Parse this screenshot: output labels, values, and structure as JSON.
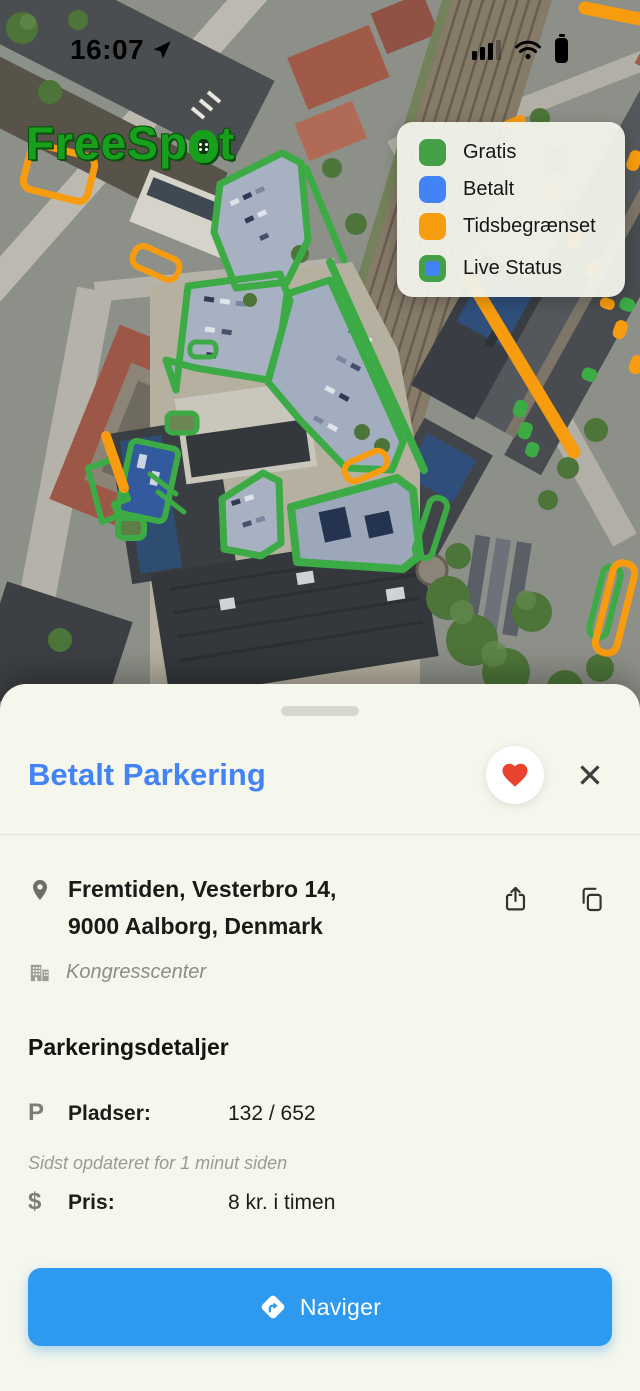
{
  "status_bar": {
    "time": "16:07"
  },
  "map": {
    "logo_full": "FreeSpot",
    "logo_prefix": "FreeSp",
    "logo_suffix": "t",
    "legend": {
      "items": [
        {
          "label": "Gratis",
          "color": "#43a047"
        },
        {
          "label": "Betalt",
          "color": "#4284f5"
        },
        {
          "label": "Tidsbegrænset",
          "color": "#f79c0e"
        },
        {
          "label": "Live Status",
          "outer_color": "#43a047",
          "inner_color": "#4284f5"
        }
      ]
    }
  },
  "sheet": {
    "title": "Betalt Parkering",
    "close_glyph": "✕",
    "address": {
      "line1": "Fremtiden, Vesterbro 14,",
      "line2": "9000 Aalborg, Denmark",
      "venue": "Kongresscenter"
    },
    "details": {
      "heading": "Parkeringsdetaljer",
      "spots_icon": "P",
      "spots_label": "Pladser:",
      "spots_value": "132 / 652",
      "updated_note": "Sidst opdateret for 1 minut siden",
      "price_icon": "$",
      "price_label": "Pris:",
      "price_value": "8 kr. i timen"
    },
    "navigate": {
      "label": "Naviger"
    }
  },
  "colors": {
    "accent_blue": "#4483f5",
    "button_blue": "#2d9af0",
    "free_green": "#43a047",
    "paid_blue": "#4284f5",
    "limited_orange": "#f79c0e",
    "heart_red": "#e8432e",
    "sheet_background": "#f5f7ec"
  }
}
